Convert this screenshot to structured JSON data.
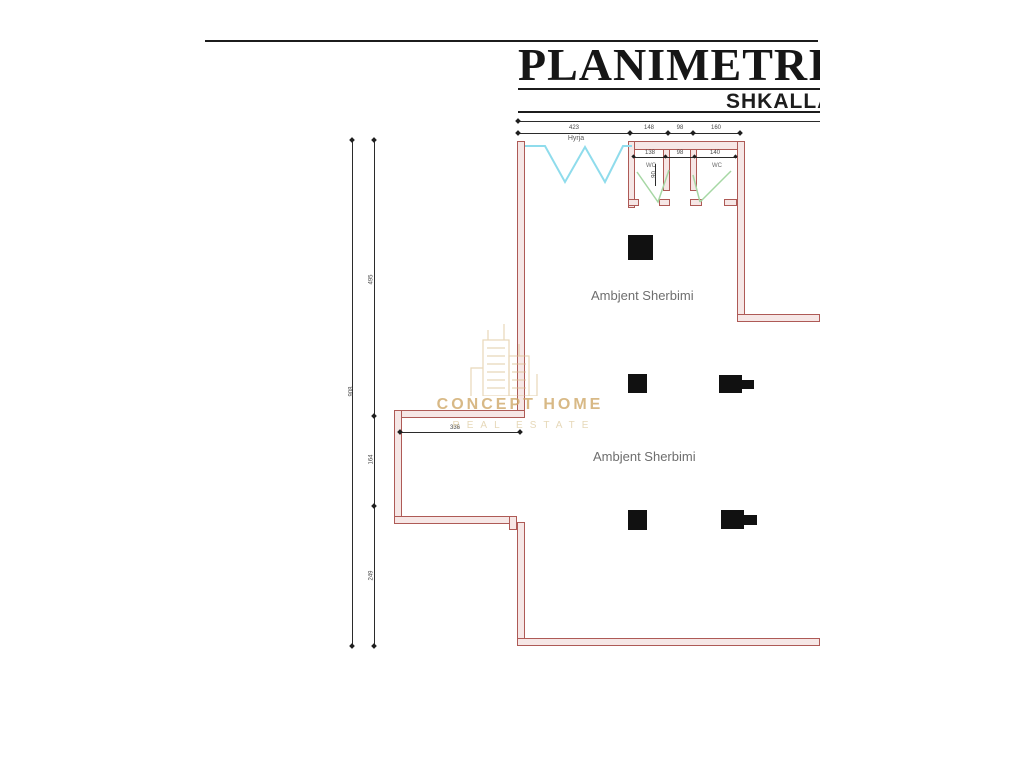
{
  "title_block": {
    "title": "PLANIMETRIA",
    "subtitle": "SHKALLA"
  },
  "watermark": {
    "line1": "CONCEPT HOME",
    "line2": "REAL ESTATE",
    "color": "#cfa868"
  },
  "labels": {
    "room1": "Ambjent Sherbimi",
    "room2": "Ambjent Sherbimi",
    "entrance": "Hyrja",
    "wc_left": "WC",
    "wc_right": "WC"
  },
  "dimensions": {
    "top_segments": [
      "423",
      "148",
      "98",
      "160"
    ],
    "wc_segments": [
      "138",
      "98",
      "140"
    ],
    "wc_door": "90",
    "left_total": "908",
    "left_segments": [
      "495",
      "164",
      "249"
    ],
    "bumpout": "336"
  },
  "colors": {
    "wall_line": "#ae5a56",
    "wall_fill": "#f6e7e6",
    "window": "#8fdcec",
    "door_swing": "#a6d7a4",
    "column": "#111111"
  }
}
